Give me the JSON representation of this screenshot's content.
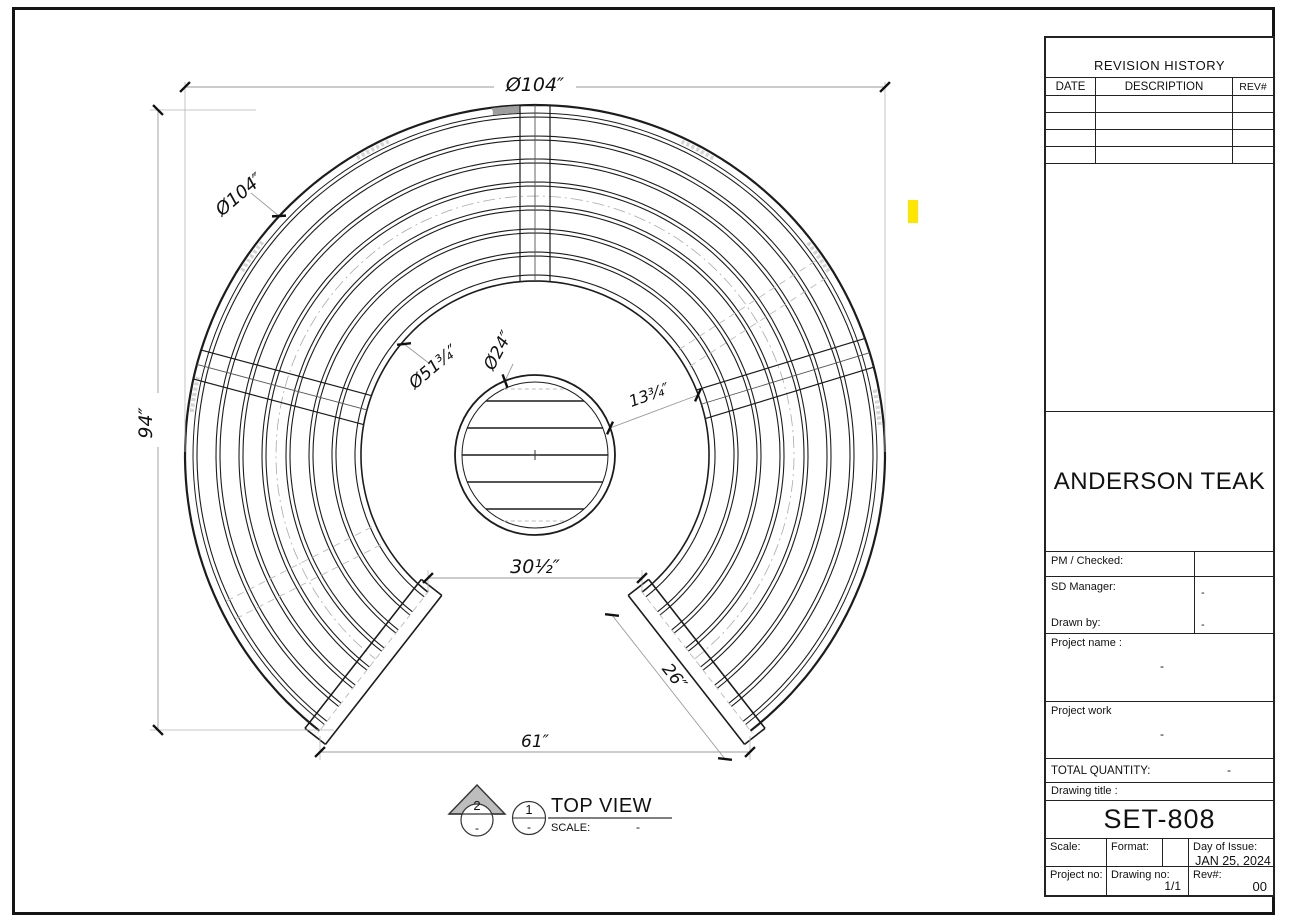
{
  "drawing": {
    "view_title": "TOP VIEW",
    "scale_label": "SCALE:",
    "scale_value": "-",
    "markers": {
      "m2": "2",
      "m2_sub": "-",
      "m1": "1",
      "m1_sub": "-"
    },
    "dimensions": {
      "outer_diameter_top": "Ø104″",
      "outer_diameter_arc": "Ø104″",
      "overall_height": "94″",
      "inner_diameter": "Ø51¾″",
      "table_diameter": "Ø24″",
      "table_to_seat_gap": "13¾″",
      "inner_opening_width": "30½″",
      "outer_opening_width": "61″",
      "seat_depth": "26″"
    }
  },
  "title_block": {
    "revision_history": {
      "title": "REVISION HISTORY",
      "col_date": "DATE",
      "col_description": "DESCRIPTION",
      "col_rev": "REV#"
    },
    "company": "ANDERSON TEAK",
    "pm_checked_label": "PM / Checked:",
    "sd_manager_label": "SD Manager:",
    "sd_manager_value": "-",
    "drawn_by_label": "Drawn by:",
    "drawn_by_value": "-",
    "project_name_label": "Project name :",
    "project_name_value": "-",
    "project_work_label": "Project work",
    "project_work_value": "-",
    "total_quantity_label": "TOTAL QUANTITY:",
    "total_quantity_value": "-",
    "drawing_title_label": "Drawing title :",
    "drawing_title_value": "SET-808",
    "scale_label": "Scale:",
    "format_label": "Format:",
    "day_of_issue_label": "Day of Issue:",
    "day_of_issue_value": "JAN 25, 2024",
    "project_no_label": "Project no:",
    "drawing_no_label": "Drawing no:",
    "drawing_no_value": "1/1",
    "rev_label": "Rev#:",
    "rev_value": "00"
  }
}
